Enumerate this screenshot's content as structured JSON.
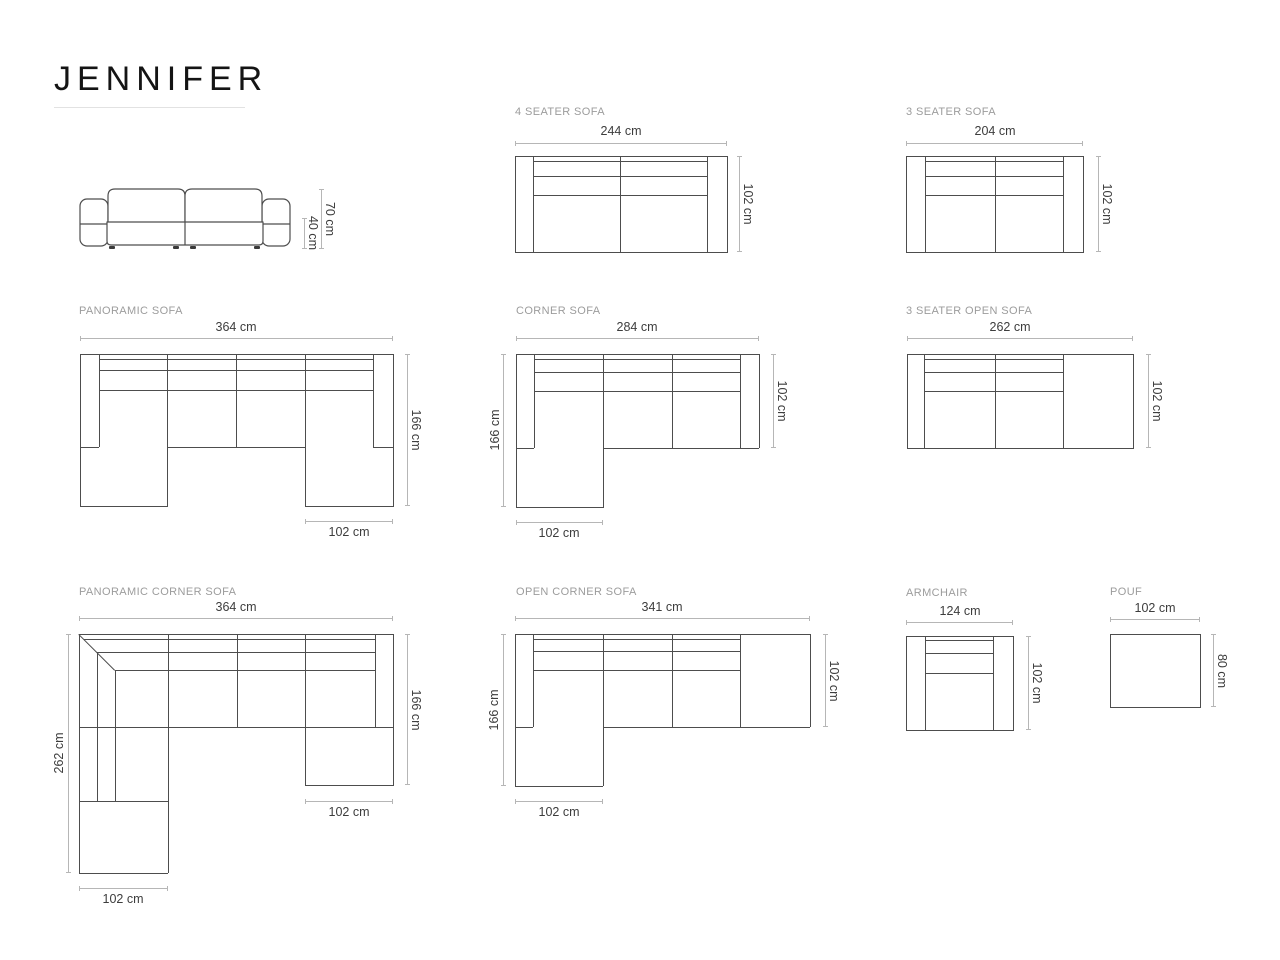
{
  "title": "JENNIFER",
  "colors": {
    "outline": "#4d4d4d",
    "dimension_line": "#b6b6b6",
    "dimension_text": "#3d3d3d",
    "label_text": "#9c9c9c",
    "title_text": "#141414"
  },
  "front_view": {
    "total_height": "70 cm",
    "seat_height": "40 cm"
  },
  "four_seater": {
    "label": "4 SEATER SOFA",
    "width": "244 cm",
    "depth": "102 cm"
  },
  "three_seater": {
    "label": "3 SEATER SOFA",
    "width": "204 cm",
    "depth": "102 cm"
  },
  "panoramic": {
    "label": "PANORAMIC SOFA",
    "width": "364 cm",
    "depth": "166 cm",
    "chaise_width": "102 cm"
  },
  "corner": {
    "label": "CORNER SOFA",
    "width": "284 cm",
    "left_depth": "166 cm",
    "right_depth": "102 cm",
    "chaise_width": "102 cm"
  },
  "three_seater_open": {
    "label": "3 SEATER OPEN SOFA",
    "width": "262 cm",
    "depth": "102 cm"
  },
  "panoramic_corner": {
    "label": "PANORAMIC CORNER SOFA",
    "width": "364 cm",
    "left_depth": "262 cm",
    "right_depth": "166 cm",
    "chaise_right_width": "102 cm",
    "chaise_bottom_width": "102 cm"
  },
  "open_corner": {
    "label": "OPEN CORNER SOFA",
    "width": "341 cm",
    "left_depth": "166 cm",
    "right_depth": "102 cm",
    "chaise_width": "102 cm"
  },
  "armchair": {
    "label": "ARMCHAIR",
    "width": "124 cm",
    "depth": "102 cm"
  },
  "pouf": {
    "label": "POUF",
    "width": "102 cm",
    "depth": "80 cm"
  }
}
